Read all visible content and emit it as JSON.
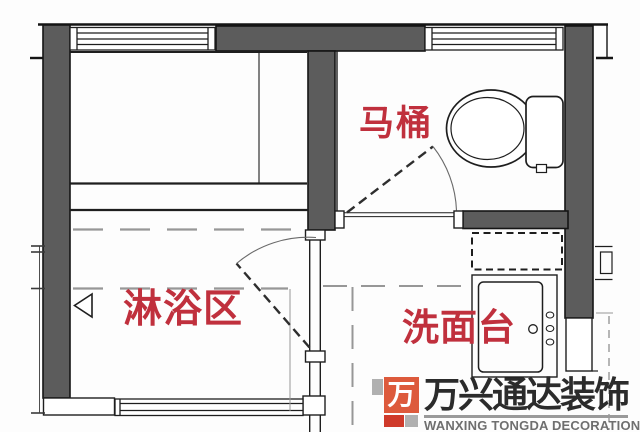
{
  "plan": {
    "labels": {
      "toilet": "马桶",
      "shower": "淋浴区",
      "vanity": "洗面台"
    },
    "colors": {
      "label_red": "#c0303d",
      "wall_gray": "#5c5c5c",
      "line_black": "#1e1e1e",
      "guide_gray": "#979797"
    }
  },
  "watermark": {
    "logo_glyph": "万",
    "name_cn": "万兴通达装饰",
    "name_en": "WANXING TONGDA DECORATION",
    "colors": {
      "logo_orange": "#dd5a3c",
      "logo_red": "#cf3a2a",
      "logo_gray": "#b0b0b0",
      "cn_text": "#2b2b2b",
      "en_text": "#6f6f6f"
    }
  }
}
